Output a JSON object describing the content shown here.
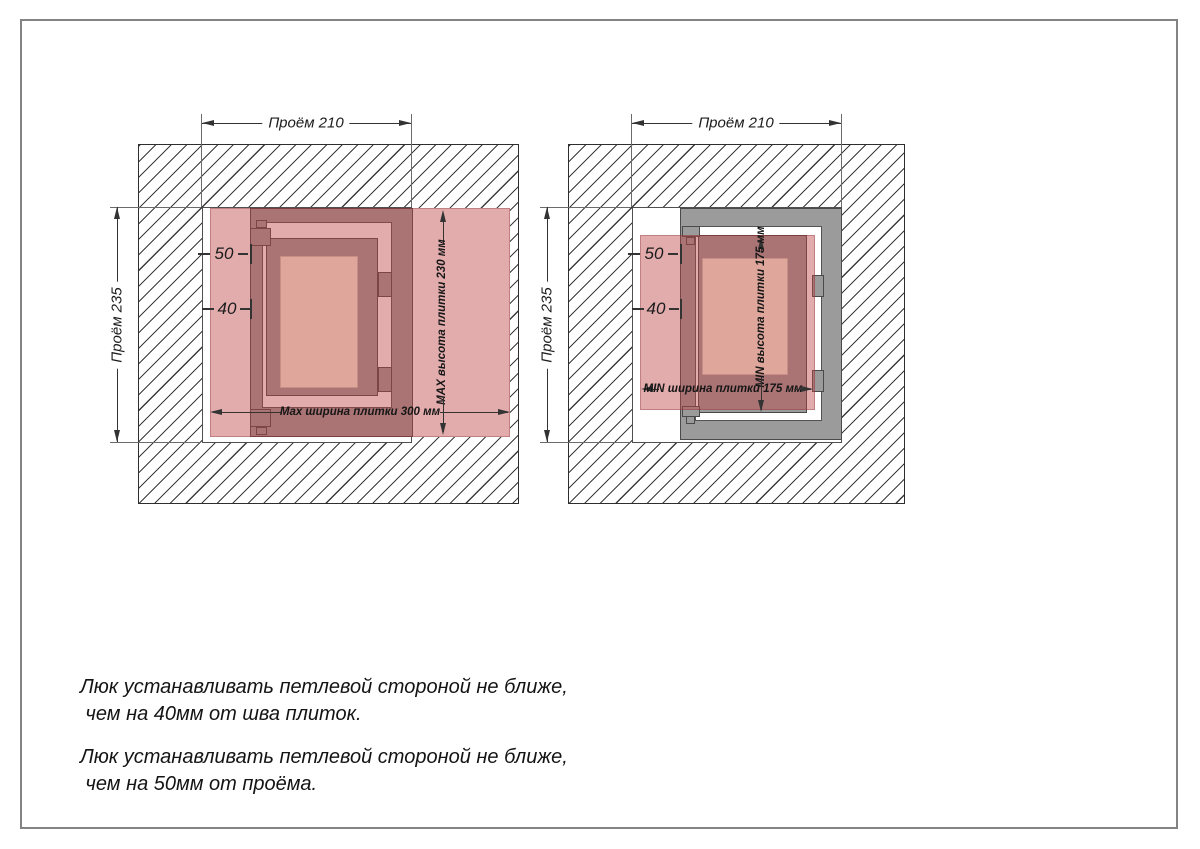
{
  "colors": {
    "tile_pink_overlay": "rgba(189,64,66,0.44)",
    "tile_over_white": "#e2abac",
    "frame_gray": "#9b9b9b",
    "door_face_cream": "#faf8e3",
    "hatch_line": "#3a3a3a",
    "dimension_line": "#333333"
  },
  "left_diagram": {
    "opening_width": "Проём 210",
    "opening_height": "Проём 235",
    "offset_from_opening": "50",
    "offset_from_seam": "40",
    "tile_width": "Max ширина плитки 300 мм",
    "tile_height": "MAX высота плитки 230 мм"
  },
  "right_diagram": {
    "opening_width": "Проём 210",
    "opening_height": "Проём 235",
    "offset_from_opening": "50",
    "offset_from_seam": "40",
    "tile_width": "MIN ширина плитки 175 мм",
    "tile_height": "MIN высота плитки 175 мм"
  },
  "notes": [
    {
      "line1": "Люк устанавливать петлевой стороной не ближе,",
      "line2": " чем на 40мм от шва плиток."
    },
    {
      "line1": "Люк устанавливать петлевой стороной не ближе,",
      "line2": " чем на 50мм от проёма."
    }
  ]
}
